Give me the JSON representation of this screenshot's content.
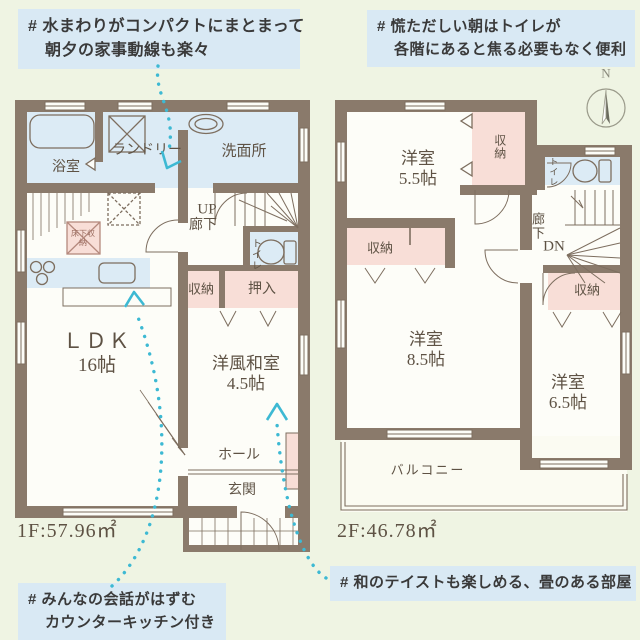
{
  "callouts": {
    "tl1": "# 水まわりがコンパクトにまとまって",
    "tl2": "朝夕の家事動線も楽々",
    "tr1": "# 慌ただしい朝はトイレが",
    "tr2": "各階にあると焦る必要もなく便利",
    "bl1": "# みんなの会話がはずむ",
    "bl2": "カウンターキッチン付き",
    "br1": "# 和のテイストも楽しめる、畳のある部屋"
  },
  "compass": {
    "north": "N"
  },
  "floor1": {
    "area": "1F:57.96㎡",
    "bath": "浴室",
    "laundry": "ランドリー",
    "washroom": "洗面所",
    "up": "UP",
    "corridor": "廊下",
    "toilet": "トイレ",
    "storage": "収納",
    "oshiire": "押入",
    "ldk": "ＬＤＫ",
    "ldk_size": "16帖",
    "tatami": "洋風和室",
    "tatami_size": "4.5帖",
    "underfloor": "床下収納",
    "hall": "ホール",
    "entrance": "玄関"
  },
  "floor2": {
    "area": "2F:46.78㎡",
    "room_a": "洋室",
    "room_a_size": "5.5帖",
    "closet_a": "収納",
    "toilet": "トイレ",
    "corridor": "廊下",
    "down": "DN",
    "closet_b": "収納",
    "room_b": "洋室",
    "room_b_size": "8.5帖",
    "closet_c": "収納",
    "room_c": "洋室",
    "room_c_size": "6.5帖",
    "balcony": "バルコニー"
  },
  "colors": {
    "background": "#eff4e3",
    "callout_bg": "#d9e9f4",
    "wall": "#8a7a6b",
    "room_pink": "#f8ded7",
    "room_blue": "#dcebf5",
    "arrow_cyan": "#3db9d3",
    "label_brown": "#5e5244"
  }
}
